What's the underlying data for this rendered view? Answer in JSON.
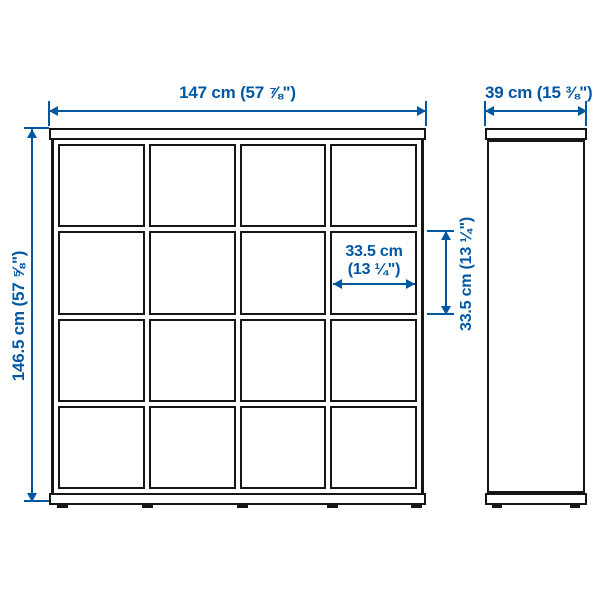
{
  "diagram": {
    "unit_front": {
      "rows": 4,
      "cols": 4,
      "cells": 16
    },
    "dimensions": {
      "total_width": "147 cm (57 ⅞\")",
      "total_depth": "39 cm (15 ⅜\")",
      "total_height": "146.5 cm (57 ⅝\")",
      "cell_width_line1": "33.5 cm",
      "cell_width_line2": "(13 ¼\")",
      "cell_height": "33.5 cm (13 ¼\")"
    },
    "colors": {
      "dimension_accent": "#0058a3",
      "outline": "#161616",
      "background": "#ffffff"
    }
  }
}
